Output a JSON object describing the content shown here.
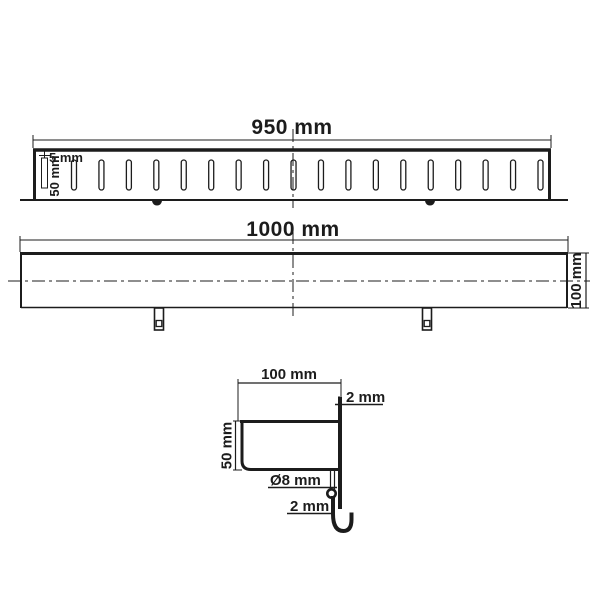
{
  "colors": {
    "background": "#ffffff",
    "line": "#1c1c1c"
  },
  "views": {
    "top": {
      "length_label": "950 mm",
      "slot_width_label": "5 mm",
      "slot_length_label": "50 mm",
      "slot_count": 18
    },
    "side": {
      "length_label": "1000 mm",
      "height_label": "100 mm"
    },
    "section": {
      "width_label": "100 mm",
      "depth_label": "50 mm",
      "edge_thickness_label": "2 mm",
      "hole_diameter_label": "Ø8 mm",
      "hook_thickness_label": "2 mm"
    }
  }
}
